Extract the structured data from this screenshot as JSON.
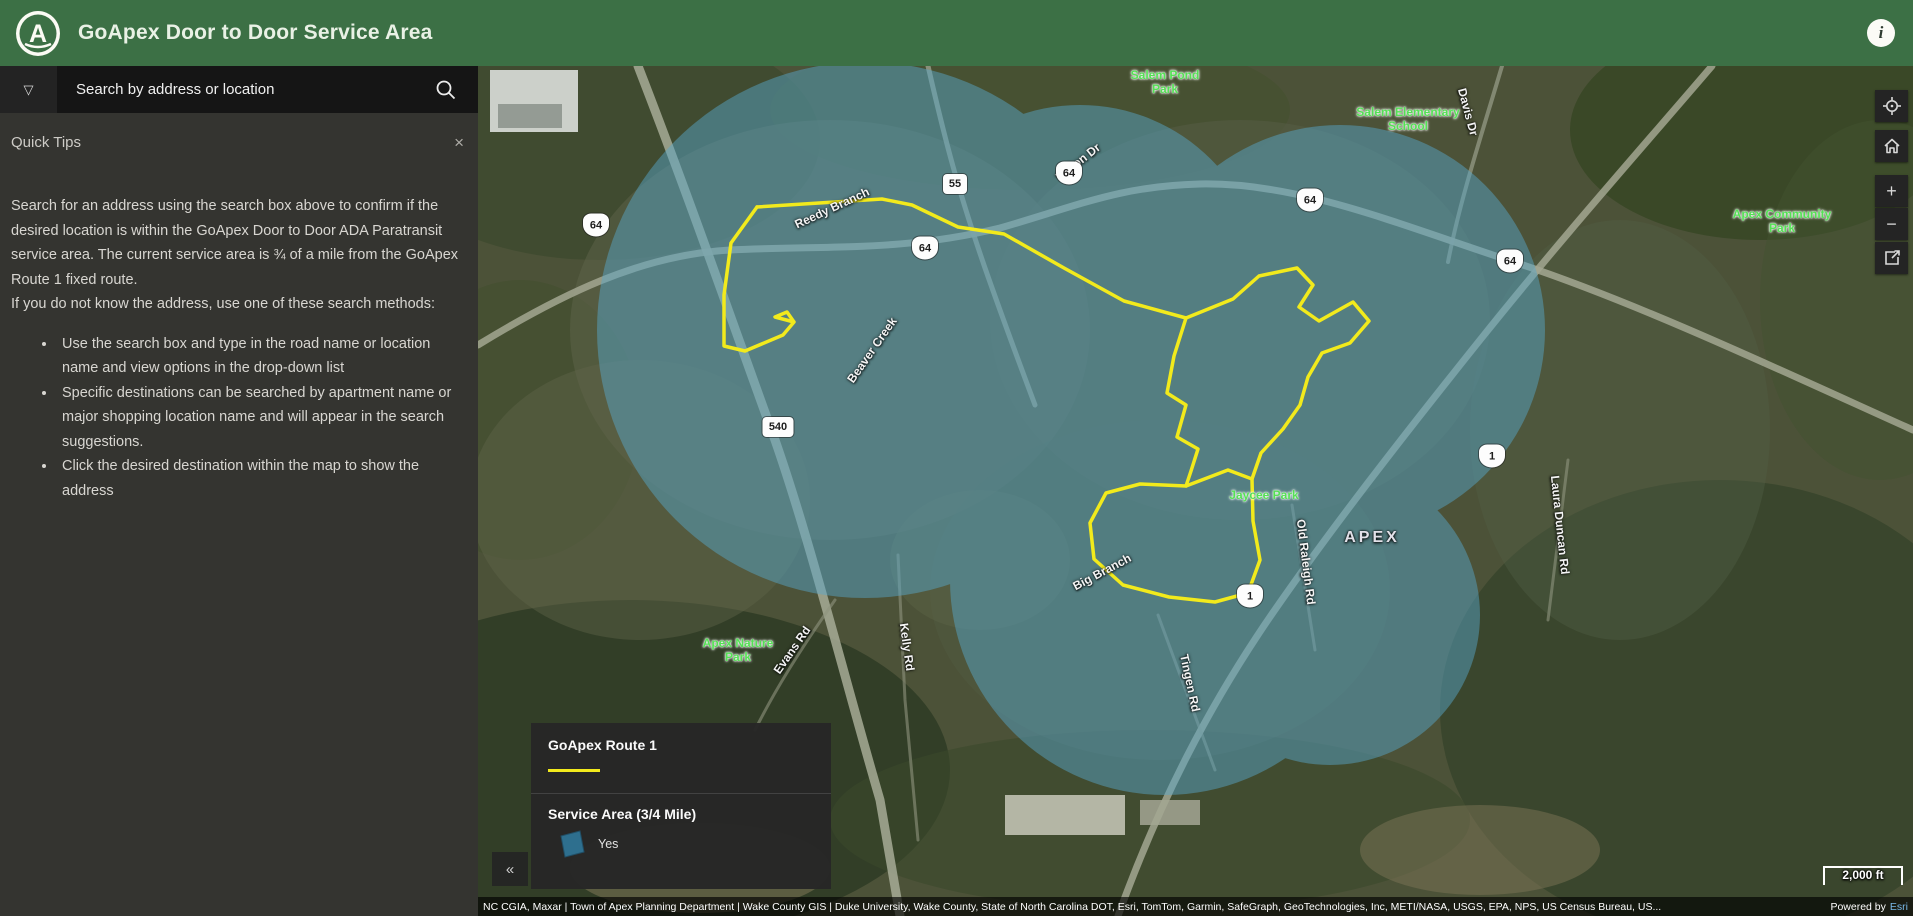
{
  "header": {
    "app_title": "GoApex Door to Door Service Area",
    "logo_letter": "A",
    "info_glyph": "i"
  },
  "search": {
    "placeholder": "Search by address or location",
    "dropdown_glyph": "▽"
  },
  "quick_tips": {
    "title": "Quick Tips",
    "close_glyph": "×",
    "paragraph1": "Search for an address using the search box above to confirm if the desired location is within the GoApex Door to Door ADA Paratransit service area. The current service area is ¾ of a mile from the GoApex Route 1 fixed route.",
    "paragraph2": "If you do not know the address, use one of these search methods:",
    "bullets": [
      "Use the search box and type in the road name or location name and view options in the drop-down list",
      "Specific destinations can be searched by apartment name or major shopping location name and will appear in the search suggestions.",
      "Click the desired destination within the map to show the address"
    ]
  },
  "legend": {
    "route_section_title": "GoApex Route 1",
    "area_section_title": "Service Area (3/4 Mile)",
    "area_item_label": "Yes",
    "route_color": "#f2ea1c",
    "area_color": "#2e6f8e",
    "service_area_fill": "#58a7ca"
  },
  "map_controls": {
    "collapse_glyph": "«",
    "zoom_in_glyph": "+",
    "zoom_out_glyph": "−"
  },
  "map": {
    "scale_label": "2,000 ft",
    "attribution": "NC CGIA, Maxar | Town of Apex Planning Department | Wake County GIS | Duke University, Wake County, State of North Carolina DOT, Esri, TomTom, Garmin, SafeGraph, GeoTechnologies, Inc, METI/NASA, USGS, EPA, NPS, US Census Bureau, US...",
    "powered_by": "Powered by",
    "powered_brand": "Esri",
    "labels": [
      {
        "type": "park",
        "text": "Salem Pond\nPark",
        "x": 687,
        "y": 16,
        "rot": 0
      },
      {
        "type": "park",
        "text": "Salem Elementary\nSchool",
        "x": 930,
        "y": 53,
        "rot": 0
      },
      {
        "type": "park",
        "text": "Apex Community\nPark",
        "x": 1304,
        "y": 155,
        "rot": 0
      },
      {
        "type": "park",
        "text": "Jaycee Park",
        "x": 786,
        "y": 429,
        "rot": 0
      },
      {
        "type": "park",
        "text": "Apex Nature\nPark",
        "x": 260,
        "y": 584,
        "rot": 0
      },
      {
        "type": "city",
        "text": "APEX",
        "x": 894,
        "y": 472,
        "rot": 0
      },
      {
        "type": "road",
        "text": "Vision Dr",
        "x": 600,
        "y": 96,
        "rot": -38
      },
      {
        "type": "road",
        "text": "Davis Dr",
        "x": 990,
        "y": 46,
        "rot": 75
      },
      {
        "type": "road",
        "text": "Reedy Branch",
        "x": 354,
        "y": 142,
        "rot": -25
      },
      {
        "type": "road",
        "text": "Beaver Creek",
        "x": 394,
        "y": 284,
        "rot": -55
      },
      {
        "type": "road",
        "text": "Evans Rd",
        "x": 314,
        "y": 584,
        "rot": -55
      },
      {
        "type": "road",
        "text": "Kelly Rd",
        "x": 429,
        "y": 581,
        "rot": 82
      },
      {
        "type": "road",
        "text": "Big Branch",
        "x": 624,
        "y": 506,
        "rot": -28
      },
      {
        "type": "road",
        "text": "Tingen Rd",
        "x": 712,
        "y": 617,
        "rot": 78
      },
      {
        "type": "road",
        "text": "Old Raleigh Rd",
        "x": 828,
        "y": 496,
        "rot": 83
      },
      {
        "type": "road",
        "text": "Laura Duncan Rd",
        "x": 1082,
        "y": 459,
        "rot": 84
      }
    ],
    "shields": [
      {
        "kind": "us",
        "text": "64",
        "x": 118,
        "y": 159
      },
      {
        "kind": "us",
        "text": "64",
        "x": 447,
        "y": 182
      },
      {
        "kind": "us",
        "text": "64",
        "x": 591,
        "y": 107
      },
      {
        "kind": "us",
        "text": "64",
        "x": 832,
        "y": 134
      },
      {
        "kind": "us",
        "text": "64",
        "x": 1032,
        "y": 195
      },
      {
        "kind": "nc",
        "text": "55",
        "x": 477,
        "y": 118
      },
      {
        "kind": "nc",
        "text": "540",
        "x": 300,
        "y": 361
      },
      {
        "kind": "us",
        "text": "1",
        "x": 772,
        "y": 530
      },
      {
        "kind": "us",
        "text": "1",
        "x": 1014,
        "y": 390
      }
    ]
  }
}
